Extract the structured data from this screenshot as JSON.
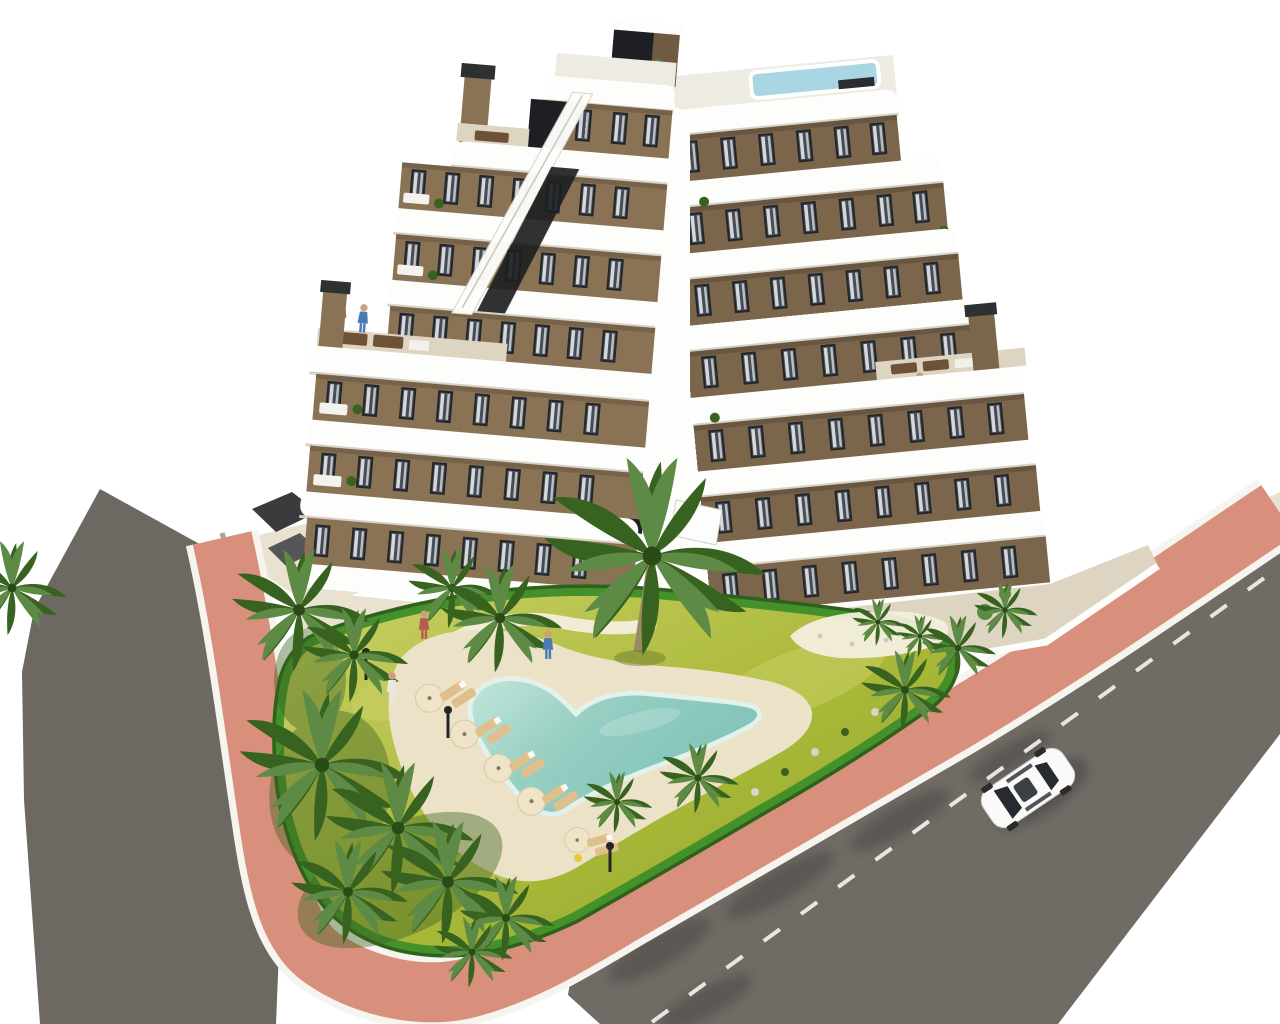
{
  "meta": {
    "kind": "aerial architectural 3D render"
  },
  "scene": {
    "building": {
      "type": "apartment block",
      "floors_visible": 7,
      "wings": 2,
      "facade_finish": "brown stucco with white curved balcony bands",
      "features": [
        "rooftop plunge pool",
        "roof terraces with dining sets",
        "stair bulkhead",
        "two chimneys",
        "glass balustrades",
        "curtained windows"
      ]
    },
    "grounds": {
      "features": [
        "free-form turquoise swimming pool",
        "sand-colored pool deck",
        "sun loungers",
        "parasols",
        "bright lawn",
        "palm trees",
        "clipped hedge border",
        "winding garden paths",
        "planted island",
        "ground-floor terraces",
        "outdoor dining table",
        "dark lounge set",
        "pool light poles"
      ]
    },
    "streets": {
      "left_road": "dark asphalt",
      "right_road": "dark asphalt with dashed white center line and tree shadows",
      "sidewalk": "salmon pink walkway with white curbs wrapping the plot",
      "vehicle": "single white car driving on right road"
    },
    "counts": {
      "palm_trees": 19,
      "sun_loungers": 10,
      "parasols": 5,
      "people": 7,
      "cars": 1
    }
  },
  "colors": {
    "bg": "#ffffff",
    "road_left": "#6e6862",
    "road_right": "#716b66",
    "road_line": "#f2f1ec",
    "road_shadow": "#2e2a26",
    "sidewalk_pink": "#d8907d",
    "curb_white": "#f6f4ef",
    "apron_beige": "#e9e2d1",
    "terrace_beige": "#ddd5c1",
    "path_sand": "#f3eedd",
    "lawn_light": "#c9d065",
    "lawn_mid": "#a9b838",
    "lawn_dark": "#8da32c",
    "hedge": "#44912b",
    "hedge_dark": "#2d611c",
    "palm_light": "#5d8a44",
    "palm_dark": "#38621f",
    "palm_trunk": "#9b8a66",
    "pool_shallow": "#c3e6dc",
    "pool_mid": "#96cec2",
    "pool_deep": "#7fc3b8",
    "pool_rim": "#e2f1ea",
    "pool_deck": "#ebe2c7",
    "band_white": "#fdfdfb",
    "band_shadow": "#d6d2c8",
    "wall_white": "#ffffff",
    "facade_left": "#8a7355",
    "facade_right": "#7b654b",
    "dark_glass": "#1d1f22",
    "slat_brown": "#6f5a42",
    "chimney_cap": "#2f3032",
    "roof_deck": "#eeebe2",
    "rooftop_pool": "#a9d6e2",
    "window_frame": "#23262a",
    "window_glass": "#454c55",
    "curtain": "#eef0f2",
    "furniture_brown": "#6e5136",
    "furniture_dark": "#503a28",
    "lounger_tan": "#dfc08c",
    "parasol_cream": "#efe3c8",
    "pole_dark": "#252525",
    "car_body": "#fafafa",
    "car_glass": "#272a30",
    "shadow_dark": "#3a3734",
    "figure_blue": "#4a7ab5",
    "figure_red": "#b85a50",
    "figure_white": "#e9e7e2",
    "figure_skin": "#caa07a"
  }
}
